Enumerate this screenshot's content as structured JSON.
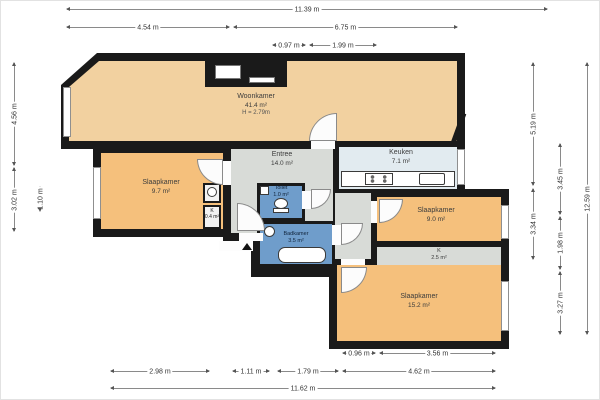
{
  "plan": {
    "rooms": {
      "woonkamer": {
        "name": "Woonkamer",
        "area": "41.4 m²",
        "ceiling_height": "H = 2.79m"
      },
      "entree": {
        "name": "Entree",
        "area": "14.0 m²"
      },
      "keuken": {
        "name": "Keuken",
        "area": "7.1 m²"
      },
      "slaapkamer_left": {
        "name": "Slaapkamer",
        "area": "9.7 m²"
      },
      "toilet": {
        "name": "Toilet",
        "area": "1.0 m²"
      },
      "badkamer": {
        "name": "Badkamer",
        "area": "3.5 m²"
      },
      "slaapkamer_right": {
        "name": "Slaapkamer",
        "area": "9.0 m²"
      },
      "closet_right": {
        "name": "K",
        "area": "2.5 m²"
      },
      "slaapkamer_bottom": {
        "name": "Slaapkamer",
        "area": "15.2 m²"
      },
      "closet_left": {
        "name": "K",
        "area": "0.4 m²"
      }
    },
    "dims": {
      "top": [
        "11.39 m",
        "4.54 m",
        "6.75 m",
        "0.97 m",
        "1.99 m"
      ],
      "bottom": [
        "0.96 m",
        "3.56 m",
        "2.98 m",
        "1.11 m",
        "1.79 m",
        "4.62 m",
        "11.62 m"
      ],
      "left": [
        "4.56 m",
        "3.02 m",
        "1.10 m"
      ],
      "right": [
        "5.19 m",
        "3.34 m",
        "3.45 m",
        "1.98 m",
        "3.27 m",
        "12.59 m"
      ]
    },
    "colors": {
      "wall": "#1a1a1a",
      "living": "#f2d1a0",
      "bedroom": "#f5c07c",
      "hall": "#d8dbd7",
      "kitchen": "#e2ebf0",
      "bath": "#6f9dcb",
      "closet": "#d8dbd7"
    }
  }
}
